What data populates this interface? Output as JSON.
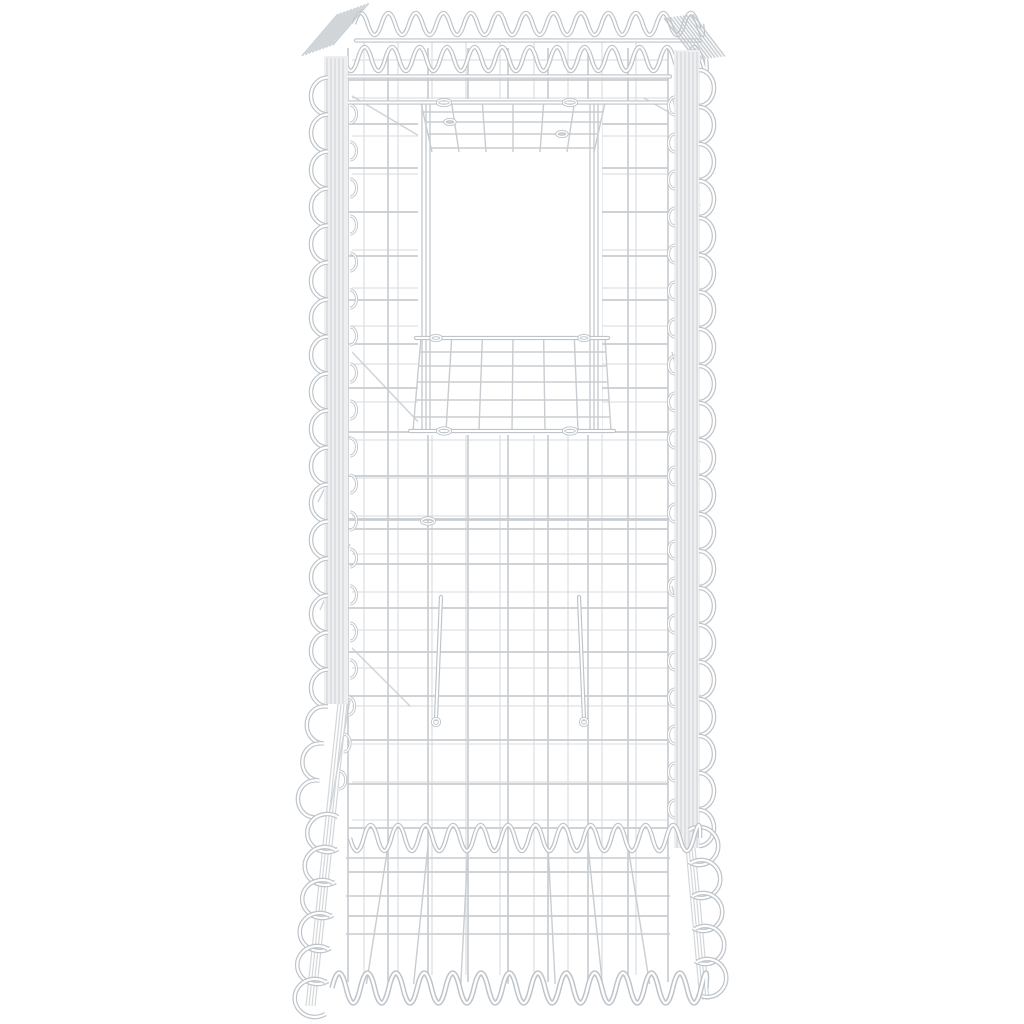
{
  "scene": {
    "colors": {
      "bg": "#ffffff",
      "wire-light": "#dde0e3",
      "wire-mid": "#c9cdd1",
      "wire-dark": "#bec4c9",
      "wire-core": "#ffffff",
      "panel-fill": "#edeff1",
      "hatch": "#d4d7da"
    },
    "mesh": {
      "front_cols": 8,
      "front_cell_w": 40,
      "front_cell_h": 44,
      "back_cell_w": 34,
      "back_cell_h": 38,
      "spiral_wavelength": 27.5,
      "edge_loop_spacing": 37,
      "front_left_x": 348,
      "front_right_x": 668,
      "top_rim_y": 77,
      "bottom_edge_y": 988,
      "shaft_opening": {
        "x0": 418,
        "x1": 602,
        "y0": 99,
        "y1": 435
      },
      "spacer_hook_span": {
        "y_top": 597,
        "y_bottom": 722
      }
    }
  }
}
